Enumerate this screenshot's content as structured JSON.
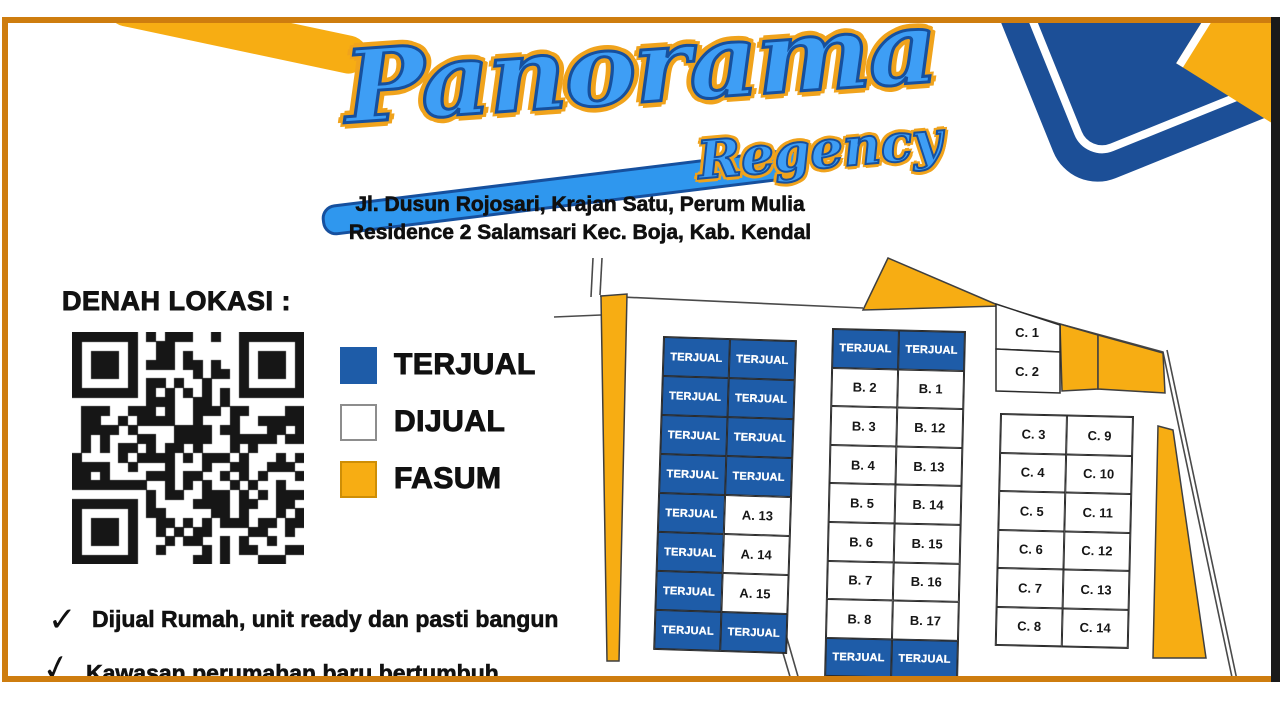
{
  "header": {
    "title_main": "Panorama",
    "title_sub": "Regency",
    "address_line1": "Jl. Dusun Rojosari, Krajan Satu, Perum Mulia",
    "address_line2": "Residence 2 Salamsari Kec. Boja, Kab. Kendal"
  },
  "location_map": {
    "heading": "DENAH LOKASI :"
  },
  "legend": {
    "items": [
      {
        "label": "TERJUAL",
        "fill": "#1E5CA8",
        "border": "#1E5CA8"
      },
      {
        "label": "DIJUAL",
        "fill": "#FFFFFF",
        "border": "#8D8D8D"
      },
      {
        "label": "FASUM",
        "fill": "#F7AD13",
        "border": "#CE8E06"
      }
    ]
  },
  "features": {
    "check_glyph": "✓",
    "items": [
      "Dijual Rumah, unit ready dan pasti bangun",
      "Kawasan perumahan baru bertumbuh"
    ]
  },
  "site_plan": {
    "sold_label": "TERJUAL",
    "c_top": [
      "C. 1",
      "C. 2"
    ],
    "block_a": [
      [
        "TERJUAL",
        "TERJUAL"
      ],
      [
        "TERJUAL",
        "TERJUAL"
      ],
      [
        "TERJUAL",
        "TERJUAL"
      ],
      [
        "TERJUAL",
        "TERJUAL"
      ],
      [
        "TERJUAL",
        "A. 13"
      ],
      [
        "TERJUAL",
        "A. 14"
      ],
      [
        "TERJUAL",
        "A. 15"
      ],
      [
        "TERJUAL",
        "TERJUAL"
      ]
    ],
    "block_b": [
      [
        "TERJUAL",
        "TERJUAL"
      ],
      [
        "B. 2",
        "B. 1"
      ],
      [
        "B. 3",
        "B. 12"
      ],
      [
        "B. 4",
        "B. 13"
      ],
      [
        "B. 5",
        "B. 14"
      ],
      [
        "B. 6",
        "B. 15"
      ],
      [
        "B. 7",
        "B. 16"
      ],
      [
        "B. 8",
        "B. 17"
      ],
      [
        "TERJUAL",
        "TERJUAL"
      ]
    ],
    "block_c": [
      [
        "C. 3",
        "C. 9"
      ],
      [
        "C. 4",
        "C. 10"
      ],
      [
        "C. 5",
        "C. 11"
      ],
      [
        "C. 6",
        "C. 12"
      ],
      [
        "C. 7",
        "C. 13"
      ],
      [
        "C. 8",
        "C. 14"
      ]
    ],
    "colors": {
      "sold": "#1E5CA8",
      "available": "#FFFFFF",
      "fasum": "#F7AD13",
      "line": "#4A4A4A"
    }
  },
  "frame": {
    "border_color": "#CE7D0F",
    "right_bar_color": "#1A1A1A"
  }
}
